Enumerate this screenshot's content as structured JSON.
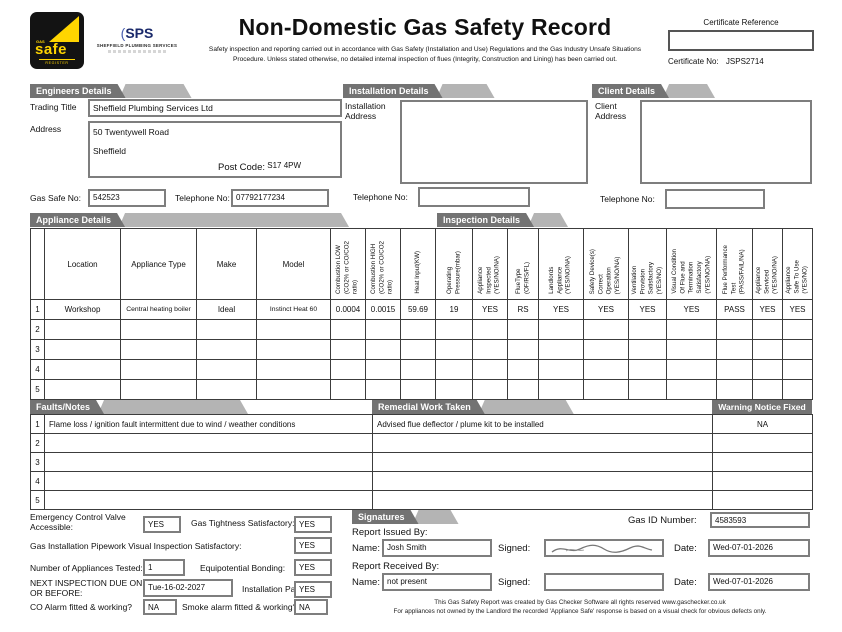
{
  "header": {
    "title": "Non-Domestic Gas Safety Record",
    "subtitle": "Safety inspection and reporting carried out in accordance with Gas Safety (Installation and Use) Regulations and the Gas Industry Unsafe Situations Procedure. Unless stated otherwise, no detailed internal inspection of flues (Integrity, Construction and Lining) has been carried out.",
    "certificate_reference_label": "Certificate Reference",
    "certificate_reference_value": "",
    "certificate_no_label": "Certificate No:",
    "certificate_no_value": "JSPS2714",
    "gas_safe_logo": {
      "gas": "GAS",
      "safe": "safe",
      "register": "REGISTER"
    },
    "sps_logo": {
      "mark": "SPS",
      "name": "SHEFFIELD PLUMBING SERVICES"
    }
  },
  "colors": {
    "tab_dark": "#737373",
    "tab_light": "#b4b4b4",
    "gas_safe_yellow": "#ffd500",
    "sps_blue": "#1b2a6b"
  },
  "engineers": {
    "section_title": "Engineers Details",
    "trading_title_label": "Trading Title",
    "trading_title": "Sheffield Plumbing Services Ltd",
    "address_label": "Address",
    "address_line1": "50 Twentywell Road",
    "address_line2": "Sheffield",
    "post_code_label": "Post Code:",
    "post_code": "S17 4PW",
    "gas_safe_no_label": "Gas Safe No:",
    "gas_safe_no": "542523",
    "telephone_label": "Telephone No:",
    "telephone": "07792177234"
  },
  "installation": {
    "section_title": "Installation Details",
    "address_label": "Installation\nAddress",
    "address": "",
    "telephone_label": "Telephone No:",
    "telephone": ""
  },
  "client": {
    "section_title": "Client Details",
    "address_label": "Client\nAddress",
    "address": "",
    "telephone_label": "Telephone No:",
    "telephone": ""
  },
  "appliance": {
    "section_title": "Appliance Details",
    "inspection_title": "Inspection Details",
    "columns": [
      "",
      "Location",
      "Appliance Type",
      "Make",
      "Model",
      "Combustion LOW\n(CO2% or CO/CO2 ratio)",
      "Combustion HIGH\n(CO2% or CO/CO2 ratio)",
      "Heat Input(KW)",
      "Operating\nPressure(mbar)",
      "Appliance\nInspected\n(YES/NO/NA)",
      "FlueType\n(OF/RS/FL)",
      "Landlords\nAppliance\n(YES/NO/NA)",
      "Safety Device(s)\nCorrect\nOperation\n(YES/NO/NA)",
      "Ventilation\nProvision\nSatisfactory\n(YES/NO)",
      "Visual Condition\nOf Flue and\nTermination\nSatisfactory\n(YES/NO/NA)",
      "Flue Performance\nTest\n(PASS/FAIL/NA)",
      "Appliance\nServiced\n(YES/NO/NA)",
      "Appliance\nSafe To Use\n(YES/NO)"
    ],
    "rows": [
      {
        "num": "1",
        "cells": [
          "Workshop",
          "Central heating boiler",
          "Ideal",
          "Instinct Heat 60",
          "0.0004",
          "0.0015",
          "59.69",
          "19",
          "YES",
          "RS",
          "YES",
          "YES",
          "YES",
          "YES",
          "PASS",
          "YES",
          "YES"
        ]
      },
      {
        "num": "2"
      },
      {
        "num": "3"
      },
      {
        "num": "4"
      },
      {
        "num": "5"
      }
    ]
  },
  "faults": {
    "title": "Faults/Notes",
    "remedial_title": "Remedial Work Taken",
    "warning_title": "Warning Notice Fixed",
    "rows": [
      {
        "num": "1",
        "fault": "Flame loss / ignition fault intermittent due to wind / weather conditions",
        "remedial": "Advised flue deflector / plume kit to be installed",
        "warning": "NA"
      },
      {
        "num": "2",
        "fault": "",
        "remedial": "",
        "warning": ""
      },
      {
        "num": "3",
        "fault": "",
        "remedial": "",
        "warning": ""
      },
      {
        "num": "4",
        "fault": "",
        "remedial": "",
        "warning": ""
      },
      {
        "num": "5",
        "fault": "",
        "remedial": "",
        "warning": ""
      }
    ]
  },
  "checks": {
    "ecv_label": "Emergency Control Valve\nAccessible:",
    "ecv_value": "YES",
    "gas_tightness_label": "Gas Tightness Satisfactory:",
    "gas_tightness_value": "YES",
    "pipework_label": "Gas Installation Pipework Visual Inspection Satisfactory:",
    "pipework_value": "YES",
    "appliances_tested_label": "Number of Appliances Tested:",
    "appliances_tested_value": "1",
    "equipotential_label": "Equipotential Bonding:",
    "equipotential_value": "YES",
    "next_inspection_label": "NEXT INSPECTION DUE ON\nOR BEFORE:",
    "next_inspection_value": "Tue-16-02-2027",
    "installation_pass_label": "Installation Pass:",
    "installation_pass_value": "YES",
    "co_alarm_label": "CO Alarm fitted & working?",
    "co_alarm_value": "NA",
    "smoke_alarm_label": "Smoke alarm fitted & working?",
    "smoke_alarm_value": "NA"
  },
  "signatures": {
    "section_title": "Signatures",
    "gas_id_label": "Gas ID Number:",
    "gas_id_value": "4583593",
    "issued_by_label": "Report Issued By:",
    "received_by_label": "Report Received By:",
    "name_label": "Name:",
    "signed_label": "Signed:",
    "date_label": "Date:",
    "issued_name": "Josh Smith",
    "issued_date": "Wed-07-01-2026",
    "received_name": "not present",
    "received_date": "Wed-07-01-2026"
  },
  "footer": {
    "line1": "This Gas Safety Report was created by Gas Checker Software all rights reserved  www.gaschecker.co.uk",
    "line2": "For appliances not owned by the Landlord the recorded 'Appliance Safe' response is based on a visual check for obvious defects only."
  }
}
